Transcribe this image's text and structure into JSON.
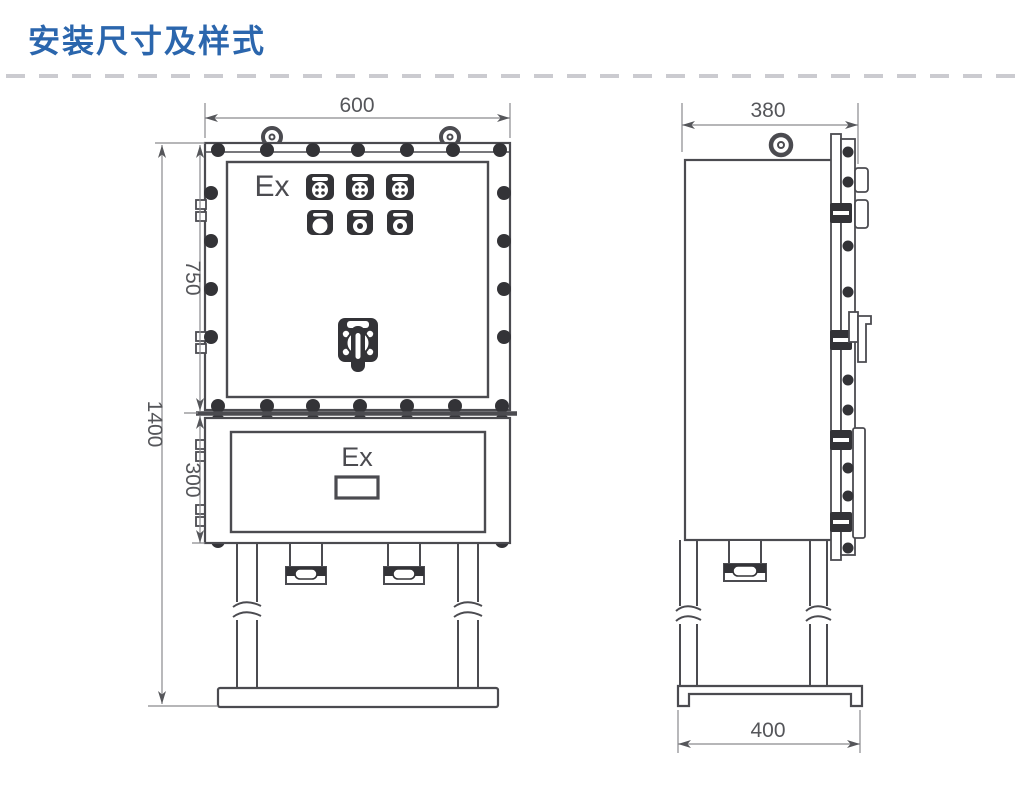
{
  "header": {
    "title": "安装尺寸及样式",
    "title_color": "#2b66ad"
  },
  "divider": {
    "style": "dashed",
    "color": "#cbcbd0"
  },
  "drawing": {
    "line_color": "#4b4b50",
    "front_view": {
      "ex_label_upper": "Ex",
      "ex_label_lower": "Ex",
      "dim_width": "600",
      "dim_upper_height": "750",
      "dim_lower_height": "300",
      "dim_total_height": "1400"
    },
    "side_view": {
      "dim_depth": "380",
      "dim_base_depth": "400"
    }
  }
}
